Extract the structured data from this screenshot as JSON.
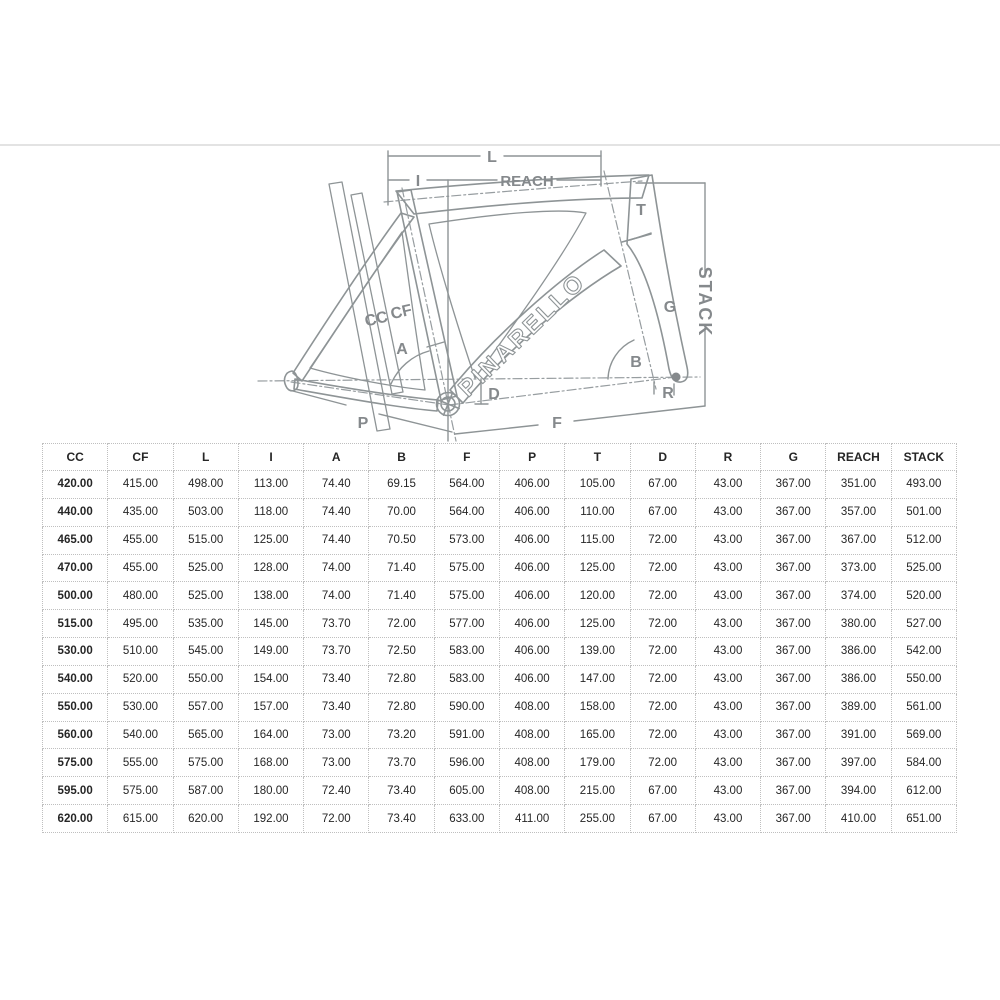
{
  "page": {
    "background": "#ffffff",
    "divider_color": "#e3e3e3"
  },
  "diagram": {
    "brand": "PINARELLO",
    "line_color": "#8e9496",
    "label_color": "#85898c",
    "labels": {
      "l": "L",
      "i": "I",
      "reach": "REACH",
      "t": "T",
      "stack": "STACK",
      "g": "G",
      "cc": "CC",
      "cf": "CF",
      "a": "A",
      "b": "B",
      "d": "D",
      "r": "R",
      "p": "P",
      "f": "F"
    }
  },
  "table": {
    "columns": [
      "CC",
      "CF",
      "L",
      "I",
      "A",
      "B",
      "F",
      "P",
      "T",
      "D",
      "R",
      "G",
      "REACH",
      "STACK"
    ],
    "rows": [
      [
        "420.00",
        "415.00",
        "498.00",
        "113.00",
        "74.40",
        "69.15",
        "564.00",
        "406.00",
        "105.00",
        "67.00",
        "43.00",
        "367.00",
        "351.00",
        "493.00"
      ],
      [
        "440.00",
        "435.00",
        "503.00",
        "118.00",
        "74.40",
        "70.00",
        "564.00",
        "406.00",
        "110.00",
        "67.00",
        "43.00",
        "367.00",
        "357.00",
        "501.00"
      ],
      [
        "465.00",
        "455.00",
        "515.00",
        "125.00",
        "74.40",
        "70.50",
        "573.00",
        "406.00",
        "115.00",
        "72.00",
        "43.00",
        "367.00",
        "367.00",
        "512.00"
      ],
      [
        "470.00",
        "455.00",
        "525.00",
        "128.00",
        "74.00",
        "71.40",
        "575.00",
        "406.00",
        "125.00",
        "72.00",
        "43.00",
        "367.00",
        "373.00",
        "525.00"
      ],
      [
        "500.00",
        "480.00",
        "525.00",
        "138.00",
        "74.00",
        "71.40",
        "575.00",
        "406.00",
        "120.00",
        "72.00",
        "43.00",
        "367.00",
        "374.00",
        "520.00"
      ],
      [
        "515.00",
        "495.00",
        "535.00",
        "145.00",
        "73.70",
        "72.00",
        "577.00",
        "406.00",
        "125.00",
        "72.00",
        "43.00",
        "367.00",
        "380.00",
        "527.00"
      ],
      [
        "530.00",
        "510.00",
        "545.00",
        "149.00",
        "73.70",
        "72.50",
        "583.00",
        "406.00",
        "139.00",
        "72.00",
        "43.00",
        "367.00",
        "386.00",
        "542.00"
      ],
      [
        "540.00",
        "520.00",
        "550.00",
        "154.00",
        "73.40",
        "72.80",
        "583.00",
        "406.00",
        "147.00",
        "72.00",
        "43.00",
        "367.00",
        "386.00",
        "550.00"
      ],
      [
        "550.00",
        "530.00",
        "557.00",
        "157.00",
        "73.40",
        "72.80",
        "590.00",
        "408.00",
        "158.00",
        "72.00",
        "43.00",
        "367.00",
        "389.00",
        "561.00"
      ],
      [
        "560.00",
        "540.00",
        "565.00",
        "164.00",
        "73.00",
        "73.20",
        "591.00",
        "408.00",
        "165.00",
        "72.00",
        "43.00",
        "367.00",
        "391.00",
        "569.00"
      ],
      [
        "575.00",
        "555.00",
        "575.00",
        "168.00",
        "73.00",
        "73.70",
        "596.00",
        "408.00",
        "179.00",
        "72.00",
        "43.00",
        "367.00",
        "397.00",
        "584.00"
      ],
      [
        "595.00",
        "575.00",
        "587.00",
        "180.00",
        "72.40",
        "73.40",
        "605.00",
        "408.00",
        "215.00",
        "67.00",
        "43.00",
        "367.00",
        "394.00",
        "612.00"
      ],
      [
        "620.00",
        "615.00",
        "620.00",
        "192.00",
        "72.00",
        "73.40",
        "633.00",
        "411.00",
        "255.00",
        "67.00",
        "43.00",
        "367.00",
        "410.00",
        "651.00"
      ]
    ]
  }
}
